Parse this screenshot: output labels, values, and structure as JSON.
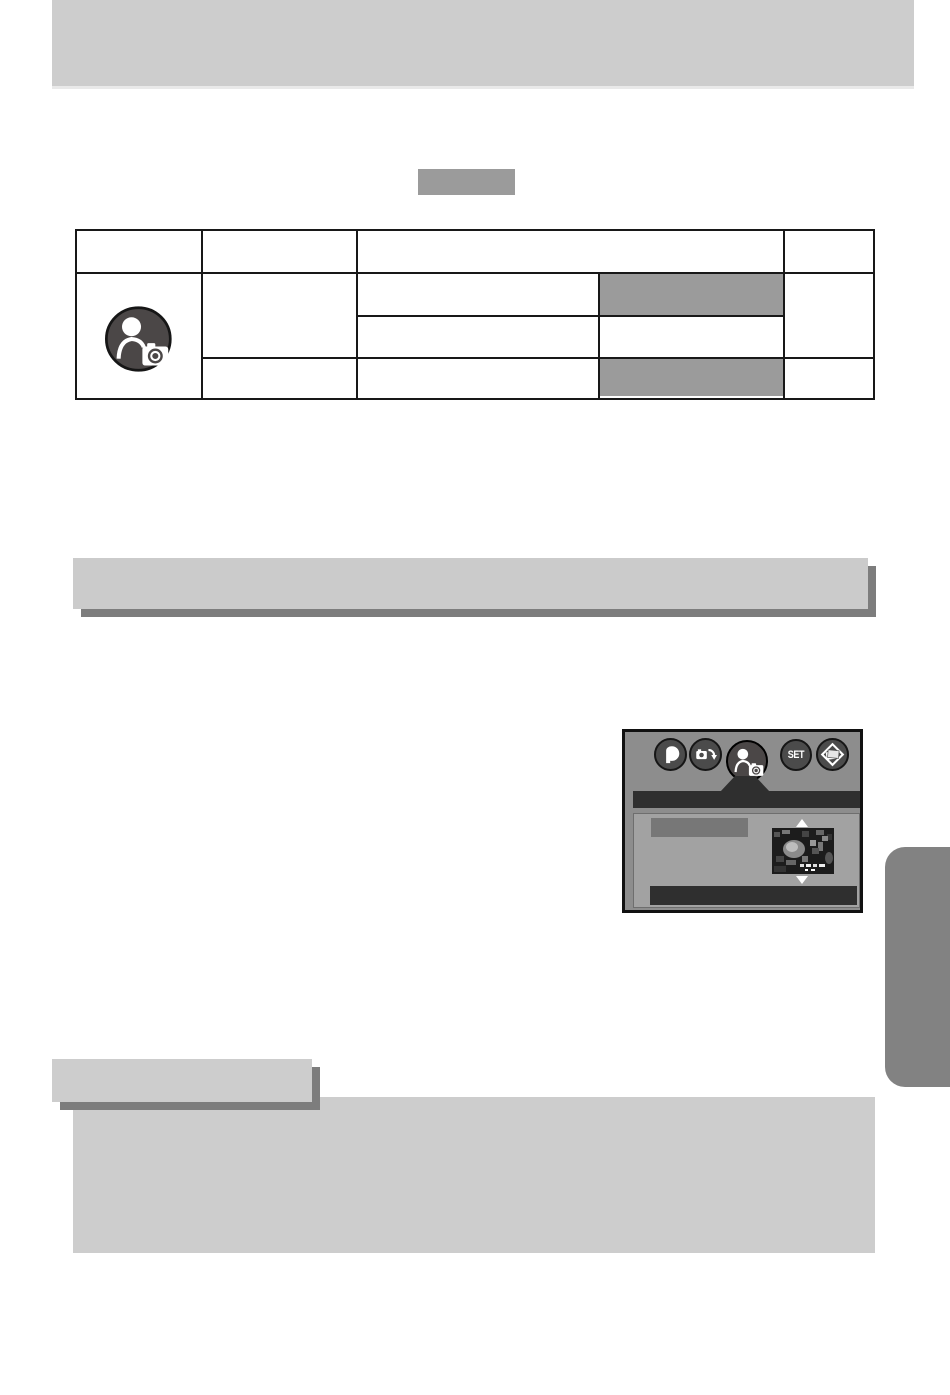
{
  "page": {
    "width": 950,
    "height": 1395,
    "background": "#ffffff"
  },
  "header_bar": {
    "color": "#cdcdcd"
  },
  "section_chip": {
    "color": "#9b9b9b"
  },
  "settings_table": {
    "border_color": "#181818",
    "header_columns": 4,
    "body_rows": 3,
    "row_icon": "portrait-scene-icon",
    "highlight_cells": [
      {
        "row": 1,
        "color": "#9b9b9b"
      },
      {
        "row": 3,
        "color": "#9b9b9b"
      }
    ]
  },
  "divider_bar": {
    "color": "#cbcbcb",
    "shadow_color": "#7d7d7d"
  },
  "camera_menu_figure": {
    "panel_color": "#8d8d8d",
    "title_bar_color": "#2f2f2f",
    "body_color": "#a2a2a2",
    "highlight_color": "#777777",
    "footer_bar_color": "#2f2f2f",
    "set_label": "SET",
    "icons": [
      {
        "name": "mode-icon",
        "selected": false
      },
      {
        "name": "camera-swap-icon",
        "selected": false
      },
      {
        "name": "scene-icon",
        "selected": true
      },
      {
        "name": "set-button-icon",
        "selected": false
      },
      {
        "name": "photo-stack-icon",
        "selected": false
      }
    ],
    "thumbnail": "noisy-preview-photo",
    "scroll_arrows": [
      "up",
      "down"
    ]
  },
  "side_tab": {
    "color": "#828282"
  },
  "information_label": {
    "color": "#cdcdcd",
    "shadow_color": "#7d7d7d"
  },
  "information_box": {
    "color": "#cdcdcd"
  }
}
